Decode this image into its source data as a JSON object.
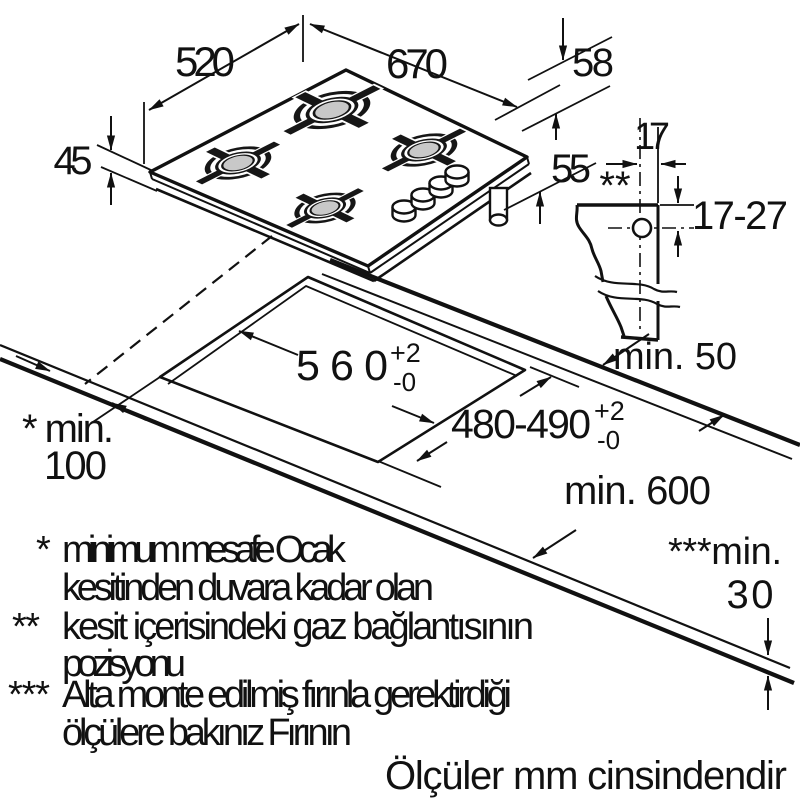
{
  "colors": {
    "line": "#111111",
    "cap": "#c8c8c8",
    "bg": "#ffffff"
  },
  "hob_dims": {
    "width": "670",
    "depth": "520",
    "grate_height": "58",
    "glass_height": "45",
    "body_height": "55"
  },
  "gas_section": {
    "asterisks": "**",
    "offset_horizontal": "17",
    "offset_vertical": "17-27",
    "rear_clearance": "min. 50"
  },
  "cutout_dims": {
    "width": "560",
    "width_plus": "+2",
    "width_minus": "-0",
    "depth": "480-490",
    "depth_plus": "+2",
    "depth_minus": "-0"
  },
  "worktop_dims": {
    "min_depth": "min. 600",
    "wall_label": "* min.",
    "wall_value": "100",
    "thickness_label": "***min.",
    "thickness_value": "30"
  },
  "footnotes": {
    "f1_marker": "*",
    "f1_line1": "minimum mesafe Ocak",
    "f1_line2": "kesitinden duvara kadar olan",
    "f2_marker": "**",
    "f2_line1": "kesit içerisindeki gaz bağlantısının",
    "f2_line2": "pozisyonu",
    "f3_marker": "***",
    "f3_line1": "Alta monte edilmiş fırınla gerektirdiği",
    "f3_line2": "ölçülere bakınız Fırının",
    "units": "Ölçüler mm cinsindendir"
  }
}
